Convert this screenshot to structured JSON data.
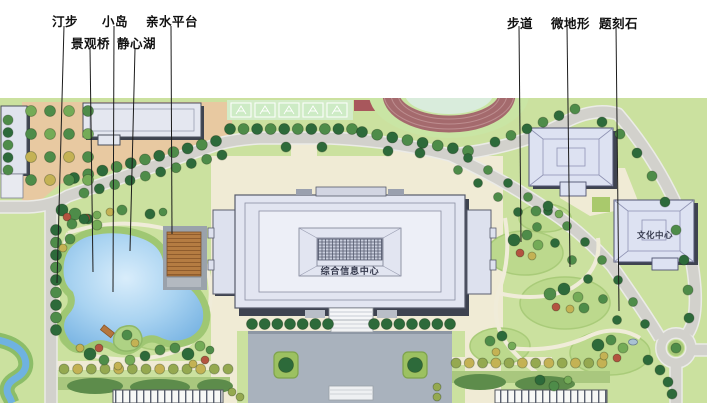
{
  "annotations": {
    "items": [
      {
        "label": "汀步"
      },
      {
        "label": "景观桥"
      },
      {
        "label": "小岛"
      },
      {
        "label": "静心湖"
      },
      {
        "label": "亲水平台"
      },
      {
        "label": "步道"
      },
      {
        "label": "微地形"
      },
      {
        "label": "题刻石"
      }
    ]
  },
  "map": {
    "main_building_label": "综合信息中心",
    "culture_center_label": "文化中心",
    "colors": {
      "lawn": "#cbe19f",
      "tan_plaza": "#e8c9a1",
      "cream_plaza": "#f0ebd5",
      "road": "#d2d1cc",
      "lake_blue": "#8fc2ea",
      "track_red": "#a46a6d",
      "building_fill": "#e2e5f1",
      "gray_plaza": "#a9b2bd",
      "tree_dark": "#2d6a3a",
      "tree_mid": "#4e8c49",
      "tree_light": "#74ab57",
      "tree_olive": "#95a950",
      "tree_yellow": "#c4b254",
      "tree_red": "#b35340",
      "leader_line": "#1c1c1c"
    }
  }
}
